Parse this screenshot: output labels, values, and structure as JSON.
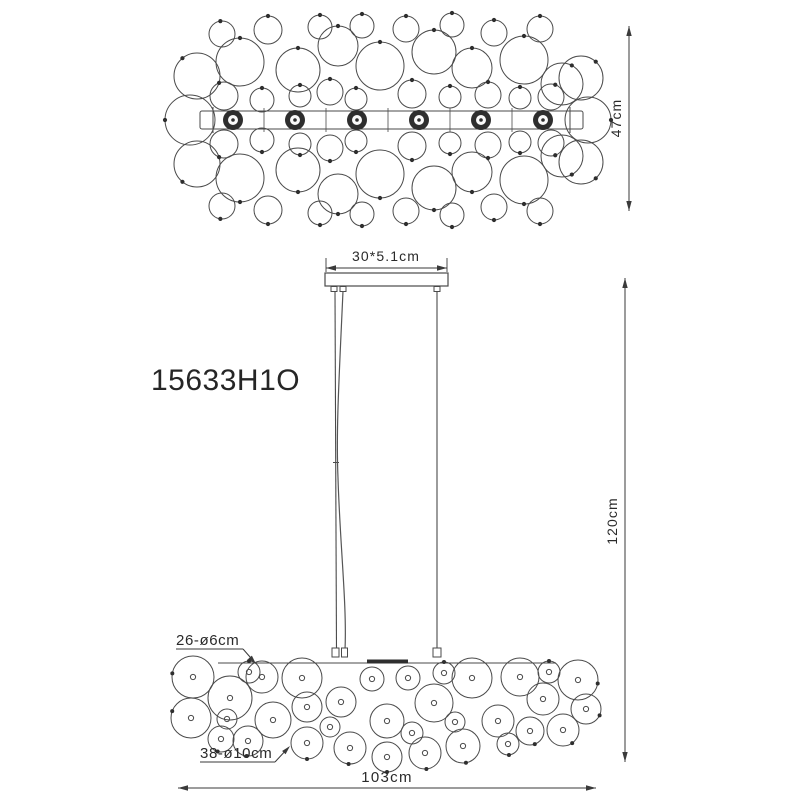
{
  "drawing": {
    "product_code": "15633H1O",
    "top_view": {
      "depth_dimension": "47cm",
      "lamp_socket_count": 6
    },
    "side_view": {
      "canopy_dimension": "30*5.1cm",
      "height_dimension": "120cm",
      "width_dimension": "103cm",
      "small_globes_label": "26-ø6cm",
      "large_globes_label": "38-ø10cm"
    },
    "colors": {
      "line": "#4a4a4a",
      "dark": "#2e2e2e",
      "dim": "#3a3a3a",
      "background": "#ffffff",
      "text": "#2a2a2a"
    }
  }
}
